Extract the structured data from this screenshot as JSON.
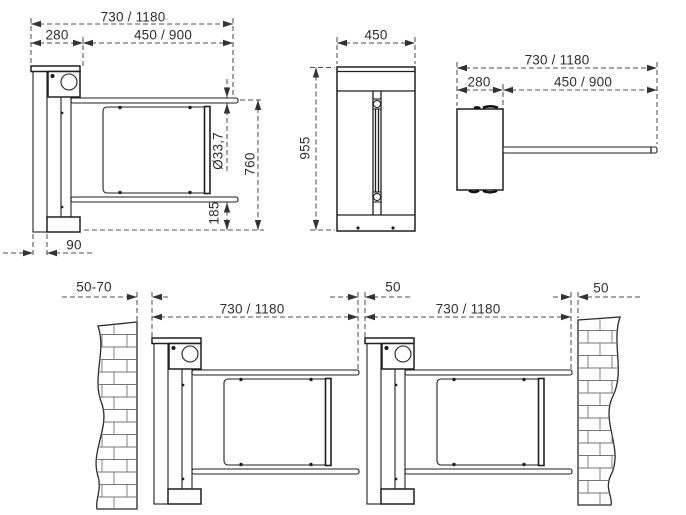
{
  "drawing_type": "technical-dimension-drawing",
  "subject": "swing gate barrier - dimensioned views",
  "colors": {
    "background": "#ffffff",
    "object_line": "#1f1f1f",
    "dim_line": "#4f4f4f",
    "text": "#2e2e2e",
    "brick_line": "#757575"
  },
  "views": {
    "side_elevation": {
      "dimensions": {
        "total_width": "730 / 1180",
        "housing_width": "280",
        "arm_length": "450 / 900",
        "tube_diameter": "Ø33,7",
        "upper_rail_height": "760",
        "lower_rail_height": "185",
        "post_depth": "90"
      }
    },
    "front_elevation": {
      "dimensions": {
        "width": "450",
        "height": "955"
      }
    },
    "top_view": {
      "dimensions": {
        "total_width": "730 / 1180",
        "housing_depth": "280",
        "arm_length": "450 / 900"
      }
    },
    "installation_view": {
      "dimensions": {
        "wall_to_unit_gap": "50-70",
        "left_unit_width": "730 / 1180",
        "between_units_gap": "50",
        "right_unit_width": "730 / 1180",
        "unit_to_wall_gap": "50"
      }
    }
  }
}
